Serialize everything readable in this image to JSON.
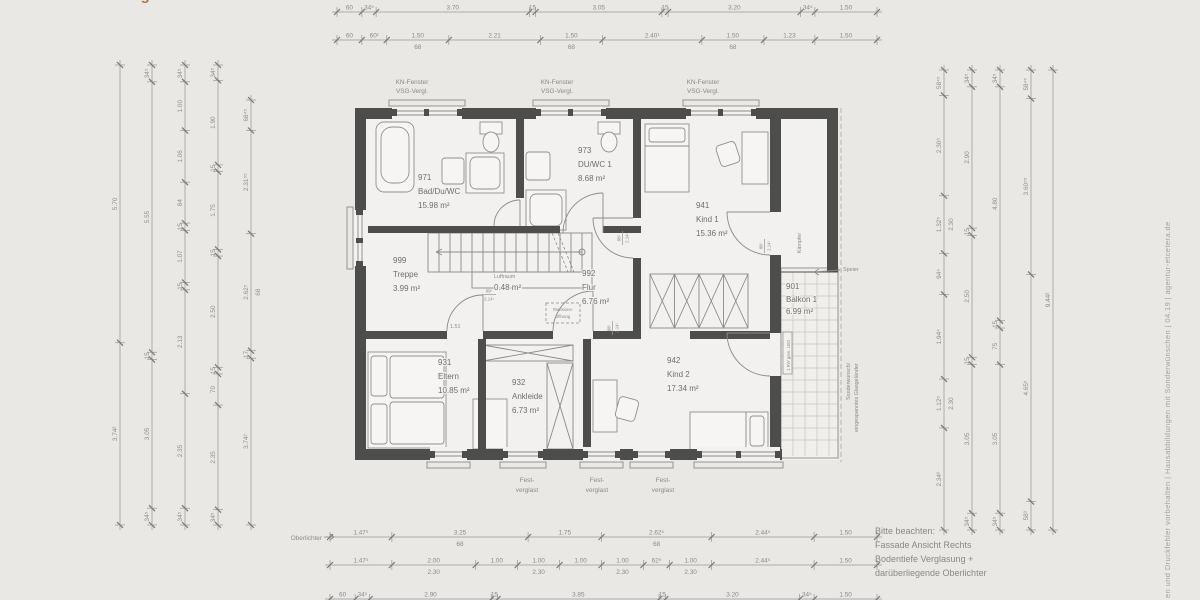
{
  "palette": {
    "background": "#eae8e5",
    "interior": "#f2f1ef",
    "wall": "#4d4d4c",
    "dim_line": "#9b9a98",
    "text_gray": "#8b8a88",
    "accent_orange": "#b5734a"
  },
  "title_fragment": "Dachgeschoss",
  "rooms": {
    "bad": {
      "id": "971",
      "name": "Bad/Du/WC",
      "area": "15.98 m²"
    },
    "duwc": {
      "id": "973",
      "name": "DU/WC 1",
      "area": "8.68 m²"
    },
    "kind1": {
      "id": "941",
      "name": "Kind 1",
      "area": "15.36 m²"
    },
    "treppe": {
      "id": "999",
      "name": "Treppe",
      "area": "3.99 m²"
    },
    "flur": {
      "id": "992",
      "name": "Flur",
      "area": "6.76 m²"
    },
    "eltern": {
      "id": "931",
      "name": "Eltern",
      "area": "10.85 m²"
    },
    "ankleide": {
      "id": "932",
      "name": "Ankleide",
      "area": "6.73 m²"
    },
    "kind2": {
      "id": "942",
      "name": "Kind 2",
      "area": "17.34 m²"
    },
    "balkon": {
      "id": "901",
      "name": "Balkon 1",
      "area": "6.99 m²"
    },
    "luftraum": {
      "name": "Luftraum",
      "area": "0.48 m²"
    }
  },
  "labels": {
    "window": {
      "l1": "KN-Fenster",
      "l2": "VSG-Vergl."
    },
    "fixed_glazing": {
      "l1": "Fest-",
      "l2": "verglast"
    },
    "oberlichter": "Oberlichter",
    "kaempfer": "Kämpfer",
    "speier": "Speier",
    "sonderwunsch_1": "Sonderwunsch/",
    "sonderwunsch_2": "eingespanntes Glasgeländer",
    "rw": "1.RW gem. LBO",
    "revision_1": "Revisions-",
    "revision_2": "öffnung",
    "door_clear": "1.51"
  },
  "note": {
    "line1": "Bitte beachten:",
    "line2": "Fassade Ansicht Rechts",
    "line3": "Bodentiefe Verglasung +",
    "line4": "darüberliegende Oberlichter"
  },
  "footer": "en und Druckfehler vorbehalten  |  Hausabbildungen mit Sonderwünschen  |  04.19  |  agentur-etcetera.de",
  "door_dims": [
    {
      "w": "89⁵",
      "h": "2.14¹",
      "x": 489,
      "y": 294,
      "rot": 0
    },
    {
      "w": "88⁵",
      "h": "2.14¹",
      "x": 622,
      "y": 238,
      "rot": -90
    },
    {
      "w": "88⁵",
      "h": "2.14¹",
      "x": 612,
      "y": 328,
      "rot": -90
    },
    {
      "w": "88⁵",
      "h": "2.14¹",
      "x": 764,
      "y": 246,
      "rot": -90
    }
  ],
  "dim_chains": [
    {
      "o": "h",
      "pos": 12,
      "from": 337,
      "to": 877,
      "segs": [
        {
          "t": "60",
          "m": 0.6
        },
        {
          "t": "34⁵",
          "m": 0.345
        },
        {
          "t": "3.70",
          "m": 3.7
        },
        {
          "t": "15",
          "m": 0.15
        },
        {
          "t": "3.05",
          "m": 3.05
        },
        {
          "t": "15",
          "m": 0.15
        },
        {
          "t": "3.20",
          "m": 3.2
        },
        {
          "t": "34⁵",
          "m": 0.345
        },
        {
          "t": "1.50",
          "m": 1.5
        }
      ]
    },
    {
      "o": "h",
      "pos": 40,
      "from": 337,
      "to": 877,
      "segs": [
        {
          "t": "60",
          "m": 0.6
        },
        {
          "t": "60¹",
          "m": 0.601
        },
        {
          "t": "1.50",
          "m": 1.5,
          "sub": "68"
        },
        {
          "t": "2.21",
          "m": 2.21
        },
        {
          "t": "1.50",
          "m": 1.5,
          "sub": "68"
        },
        {
          "t": "2.40¹",
          "m": 2.401
        },
        {
          "t": "1.50",
          "m": 1.5,
          "sub": "68"
        },
        {
          "t": "1.23",
          "m": 1.23
        },
        {
          "t": "1.50",
          "m": 1.5
        }
      ]
    },
    {
      "o": "h",
      "pos": 537,
      "from": 330,
      "to": 877,
      "segs": [
        {
          "t": "1.47⁵",
          "m": 1.475
        },
        {
          "t": "3.25",
          "m": 3.25,
          "sub": "68"
        },
        {
          "t": "1.75",
          "m": 1.75
        },
        {
          "t": "2.62⁵",
          "m": 2.625,
          "sub": "68"
        },
        {
          "t": "2.44⁵",
          "m": 2.445
        },
        {
          "t": "1.50",
          "m": 1.5
        }
      ]
    },
    {
      "o": "h",
      "pos": 565,
      "from": 330,
      "to": 877,
      "segs": [
        {
          "t": "1.47⁵",
          "m": 1.475
        },
        {
          "t": "2.00",
          "m": 2.0,
          "sub": "2.30"
        },
        {
          "t": "1.00",
          "m": 1.0
        },
        {
          "t": "1.00",
          "m": 1.0,
          "sub": "2.30"
        },
        {
          "t": "1.00",
          "m": 1.0
        },
        {
          "t": "1.00",
          "m": 1.0,
          "sub": "2.30"
        },
        {
          "t": "62⁵",
          "m": 0.625
        },
        {
          "t": "1.00",
          "m": 1.0,
          "sub": "2.30"
        },
        {
          "t": "2.44⁵",
          "m": 2.445
        },
        {
          "t": "1.50",
          "m": 1.5
        }
      ]
    },
    {
      "o": "h",
      "pos": 599,
      "from": 330,
      "to": 877,
      "segs": [
        {
          "t": "60",
          "m": 0.6
        },
        {
          "t": "34⁵",
          "m": 0.345
        },
        {
          "t": "2.90",
          "m": 2.9
        },
        {
          "t": "15",
          "m": 0.15
        },
        {
          "t": "3.85",
          "m": 3.85
        },
        {
          "t": "15",
          "m": 0.15
        },
        {
          "t": "3.20",
          "m": 3.2
        },
        {
          "t": "34⁵",
          "m": 0.345
        },
        {
          "t": "1.50",
          "m": 1.5
        }
      ]
    },
    {
      "o": "v",
      "pos": 120,
      "from": 65,
      "to": 525,
      "segs": [
        {
          "t": "5.70",
          "m": 5.7
        },
        {
          "t": "3.74²",
          "m": 3.742
        }
      ]
    },
    {
      "o": "v",
      "pos": 152,
      "from": 65,
      "to": 525,
      "segs": [
        {
          "t": "34⁵",
          "m": 0.345
        },
        {
          "t": "5.55",
          "m": 5.55
        },
        {
          "t": "15",
          "m": 0.15
        },
        {
          "t": "3.05",
          "m": 3.05
        },
        {
          "t": "34⁵",
          "m": 0.345
        }
      ]
    },
    {
      "o": "v",
      "pos": 185,
      "from": 65,
      "to": 525,
      "segs": [
        {
          "t": "34⁵",
          "m": 0.345
        },
        {
          "t": "1.00",
          "m": 1.0
        },
        {
          "t": "1.06",
          "m": 1.06
        },
        {
          "t": "84",
          "m": 0.84
        },
        {
          "t": "15",
          "m": 0.15
        },
        {
          "t": "1.07",
          "m": 1.07
        },
        {
          "t": "15",
          "m": 0.15
        },
        {
          "t": "2.13",
          "m": 2.13
        },
        {
          "t": "2.35",
          "m": 2.35
        },
        {
          "t": "34⁵",
          "m": 0.345
        }
      ]
    },
    {
      "o": "v",
      "pos": 218,
      "from": 65,
      "to": 525,
      "segs": [
        {
          "t": "34⁵",
          "m": 0.345
        },
        {
          "t": "1.90",
          "m": 1.9
        },
        {
          "t": "15",
          "m": 0.15
        },
        {
          "t": "1.75",
          "m": 1.75
        },
        {
          "t": "15",
          "m": 0.15
        },
        {
          "t": "2.50",
          "m": 2.5
        },
        {
          "t": "15",
          "m": 0.15
        },
        {
          "t": "70",
          "m": 0.7
        },
        {
          "t": "2.35",
          "m": 2.35
        },
        {
          "t": "34⁵",
          "m": 0.345
        }
      ]
    },
    {
      "o": "v",
      "pos": 251,
      "from": 100,
      "to": 525,
      "segs": [
        {
          "t": "68⁴⁵",
          "m": 0.6845
        },
        {
          "t": "2.31⁵⁵",
          "m": 2.3155
        },
        {
          "t": "2.62⁵",
          "m": 2.625,
          "sub": "68"
        },
        {
          "t": "17",
          "m": 0.17
        },
        {
          "t": "3.74²",
          "m": 3.742
        }
      ]
    },
    {
      "o": "v",
      "pos": 944,
      "from": 70,
      "to": 530,
      "segs": [
        {
          "t": "58⁴⁵",
          "m": 0.5845
        },
        {
          "t": "2.30⁶",
          "m": 2.306
        },
        {
          "t": "1.32⁵",
          "m": 1.325,
          "sub": "2.30"
        },
        {
          "t": "94⁴",
          "m": 0.944
        },
        {
          "t": "1.94⁴",
          "m": 1.944
        },
        {
          "t": "1.12⁵",
          "m": 1.125,
          "sub": "2.30"
        },
        {
          "t": "2.34⁶",
          "m": 2.346
        }
      ]
    },
    {
      "o": "v",
      "pos": 972,
      "from": 70,
      "to": 530,
      "segs": [
        {
          "t": "34⁵",
          "m": 0.345
        },
        {
          "t": "2.90",
          "m": 2.9
        },
        {
          "t": "15",
          "m": 0.15
        },
        {
          "t": "2.50",
          "m": 2.5
        },
        {
          "t": "15",
          "m": 0.15
        },
        {
          "t": "3.05",
          "m": 3.05
        },
        {
          "t": "34⁵",
          "m": 0.345
        }
      ]
    },
    {
      "o": "v",
      "pos": 1000,
      "from": 70,
      "to": 530,
      "segs": [
        {
          "t": "34⁵",
          "m": 0.345
        },
        {
          "t": "4.80",
          "m": 4.8
        },
        {
          "t": "15",
          "m": 0.15
        },
        {
          "t": "75",
          "m": 0.75
        },
        {
          "t": "3.05",
          "m": 3.05
        },
        {
          "t": "34⁵",
          "m": 0.345
        }
      ]
    },
    {
      "o": "v",
      "pos": 1031,
      "from": 70,
      "to": 530,
      "segs": [
        {
          "t": "58⁴⁵",
          "m": 0.5845
        },
        {
          "t": "3.60⁵⁵",
          "m": 3.6055
        },
        {
          "t": "4.65⁵",
          "m": 4.655
        },
        {
          "t": "58³",
          "m": 0.583
        }
      ]
    },
    {
      "o": "v",
      "pos": 1053,
      "from": 70,
      "to": 530,
      "segs": [
        {
          "t": "9.44²",
          "m": 9.442
        }
      ]
    }
  ]
}
